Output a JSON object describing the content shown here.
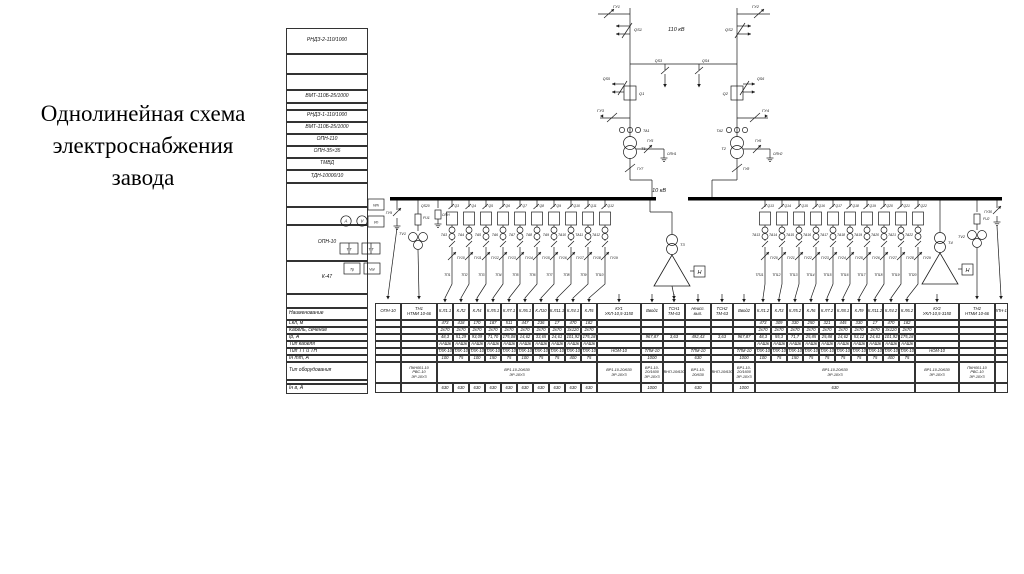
{
  "title": {
    "line1": "Однолинейная схема",
    "line2": "электроснабжения",
    "line3": "завода"
  },
  "legend": {
    "items": [
      "РНДЗ-2-110/1000",
      "",
      "",
      "ВМТ-110Б-25/1000",
      "",
      "РНДЗ-1-110/1000",
      "ВМТ-110Б-25/1000",
      "ОПН-110",
      "ОПН-35×35",
      "ТМВД",
      "ТДН-10000/10",
      "",
      "",
      "ОПН-10",
      "К-47",
      ""
    ]
  },
  "row_headers": [
    "Наименование",
    "Lкл, м",
    "Кабель, сечение",
    "Iр, А",
    "Тип кабеля",
    "Тип ТТ и ТН",
    "Iн тт, А",
    "Тип оборудования",
    "",
    "Iн в, А"
  ],
  "diagram": {
    "voltage_high": "110 кВ",
    "voltage_low": "10 кВ",
    "left_incomer": {
      "gu_top": "ГУ1",
      "qs": "QS1",
      "qs_low": "QS5",
      "q": "Q1",
      "gu_line": "ГУ3",
      "ta": "ТА1",
      "tr": "Т1",
      "gu_opn": "ГУ5",
      "opn": "ОПН1",
      "gu_sw": "ГУ7"
    },
    "right_incomer": {
      "gu_top": "ГУ2",
      "qs": "QS2",
      "qs_low": "QS6",
      "q": "Q2",
      "gu_line": "ГУ4",
      "ta": "ТА2",
      "tr": "Т2",
      "gu_opn": "ГУ6",
      "opn": "ОПН2",
      "gu_sw": "ГУ8"
    },
    "tie": {
      "qs_left": "QS3",
      "qs_right": "QS4"
    },
    "vt_left": {
      "label": "ТV1",
      "fuse": "FU1",
      "qs": "QS20",
      "gu": "ГУ9",
      "opn": "ОПН"
    },
    "vt_right": {
      "label": "ТV2",
      "fuse": "FU2",
      "gu": "ГУ30"
    },
    "tsn_left": {
      "tr": "Т3",
      "load": "Н"
    },
    "tsn_right": {
      "tr": "Т4",
      "load": "Н"
    },
    "instruments": [
      {
        "shape": "box",
        "label": "Wh"
      },
      {
        "shape": "circle",
        "label": "A"
      },
      {
        "shape": "circle",
        "label": "V"
      },
      {
        "shape": "box",
        "label": "Vh"
      },
      {
        "shape": "box2",
        "label": "Т Т"
      },
      {
        "shape": "box2",
        "label": "Т Т"
      },
      {
        "shape": "box",
        "label": "Тр"
      },
      {
        "shape": "box",
        "label": "Var"
      }
    ],
    "left_feeders": [
      {
        "q": "Q3",
        "ta": "ТА3",
        "gu": "ГУ10",
        "tp": "ТП1"
      },
      {
        "q": "Q4",
        "ta": "ТА4",
        "gu": "ГУ11",
        "tp": "ТП2"
      },
      {
        "q": "Q5",
        "ta": "ТА5",
        "gu": "ГУ12",
        "tp": "ТП3"
      },
      {
        "q": "Q6",
        "ta": "ТА6",
        "gu": "ГУ13",
        "tp": "ТП4"
      },
      {
        "q": "Q7",
        "ta": "ТА7",
        "gu": "ГУ14",
        "tp": "ТП5"
      },
      {
        "q": "Q8",
        "ta": "ТА8",
        "gu": "ГУ15",
        "tp": "ТП6"
      },
      {
        "q": "Q9",
        "ta": "ТА9",
        "gu": "ГУ16",
        "tp": "ТП7"
      },
      {
        "q": "Q10",
        "ta": "ТА10",
        "gu": "ГУ17",
        "tp": "ТП8"
      },
      {
        "q": "Q11",
        "ta": "ТА11",
        "gu": "ГУ18",
        "tp": "ТП9"
      },
      {
        "q": "Q12",
        "ta": "ТА12",
        "gu": "ГУ19",
        "tp": "ТП10"
      }
    ],
    "right_feeders": [
      {
        "q": "Q13",
        "ta": "ТА13",
        "gu": "ГУ20",
        "tp": "ТП11"
      },
      {
        "q": "Q14",
        "ta": "ТА14",
        "gu": "ГУ21",
        "tp": "ТП12"
      },
      {
        "q": "Q15",
        "ta": "ТА15",
        "gu": "ГУ22",
        "tp": "ТП13"
      },
      {
        "q": "Q16",
        "ta": "ТА16",
        "gu": "ГУ23",
        "tp": "ТП14"
      },
      {
        "q": "Q17",
        "ta": "ТА17",
        "gu": "ГУ24",
        "tp": "ТП15"
      },
      {
        "q": "Q18",
        "ta": "ТА18",
        "gu": "ГУ25",
        "tp": "ТП16"
      },
      {
        "q": "Q19",
        "ta": "ТА19",
        "gu": "ГУ26",
        "tp": "ТП17"
      },
      {
        "q": "Q20",
        "ta": "ТА20",
        "gu": "ГУ27",
        "tp": "ТП18"
      },
      {
        "q": "Q21",
        "ta": "ТА21",
        "gu": "ГУ28",
        "tp": "ТП19"
      },
      {
        "q": "Q22",
        "ta": "ТА22",
        "gu": "ГУ29",
        "tp": "ТП20"
      }
    ]
  },
  "table": {
    "merged": {
      "equip_left": "ВР1-10-20/630\nЭР-10У3",
      "equip_right": "ВР1-10-20/630\nЭР-10У3",
      "inb_right": "630"
    },
    "columns": [
      {
        "n": "ОПН-10"
      },
      {
        "n": "ТН1",
        "n2": "НТМИ 10-66",
        "eq": "ПКН001-10\nРВС-10\nЭР-10У3"
      },
      {
        "n": "К.Л1.1",
        "l": "473",
        "s": "2х70",
        "ir": "48,3",
        "c": "ААШв",
        "tt": "ТЛК-10",
        "it": "100",
        "ib": "630"
      },
      {
        "n": "К.Л2",
        "l": "418",
        "s": "2х70",
        "ir": "51,29",
        "c": "ААШв",
        "tt": "ТЛК-10",
        "it": "75",
        "ib": "630"
      },
      {
        "n": "К.Л4",
        "l": "170",
        "s": "2х70",
        "ir": "93,09",
        "c": "ААШв",
        "tt": "ТЛК-10",
        "it": "100",
        "ib": "630"
      },
      {
        "n": "К.Л5.1",
        "l": "187",
        "s": "2х70",
        "ir": "71,70",
        "c": "ААШв",
        "tt": "ТЛК-10",
        "it": "150",
        "ib": "630"
      },
      {
        "n": "К.Л7.1",
        "l": "511",
        "s": "2х70",
        "ir": "175,08",
        "c": "ААШв",
        "tt": "ТЛК-10",
        "it": "75",
        "ib": "630"
      },
      {
        "n": "К.Л6.1",
        "l": "447",
        "s": "2х70",
        "ir": "14,62",
        "c": "ААШв",
        "tt": "ТЛК-10",
        "it": "100",
        "ib": "630"
      },
      {
        "n": "К.Л10",
        "l": "236",
        "s": "2х70",
        "ir": "33,65",
        "c": "ААШв",
        "tt": "ТЛК-10",
        "it": "75",
        "ib": "630"
      },
      {
        "n": "К.Л11.1",
        "l": "17",
        "s": "2х70",
        "ir": "24,61",
        "c": "ААШв",
        "tt": "ТЛК-10",
        "it": "75",
        "ib": "630"
      },
      {
        "n": "К.Л4.1",
        "l": "470",
        "s": "3х120",
        "ir": "101,92",
        "c": "ААШв",
        "tt": "ТЛК-10",
        "it": "400",
        "ib": "630"
      },
      {
        "n": "К.Л5",
        "l": "182",
        "s": "2х70",
        "ir": "175,18",
        "c": "ААШв",
        "tt": "ТЛК-10",
        "it": "75",
        "ib": "630"
      },
      {
        "n": "КУ1",
        "n2": "УКЛ-10,5-3150",
        "tt": "НОМ-10",
        "eq": "ВР1-10-20/630\nЭР-10У3"
      },
      {
        "n": "Ввод1",
        "ir": "967,87",
        "tt": "ТЛМ-10",
        "it": "1000",
        "eq": "ВР1-10-20/1600\nЭР-10У3",
        "ib": "1000"
      },
      {
        "n": "ТСН1",
        "n2": "ТМ-63",
        "ir": "3,63",
        "eq": "ВНП-10/630"
      },
      {
        "n": "Неисп.",
        "n2": "вып.",
        "ir": "492,43",
        "tt": "ТЛМ-10",
        "it": "630",
        "eq": "ВР1-10-20/630",
        "ib": "630"
      },
      {
        "n": "ТСН2",
        "n2": "ТМ-63",
        "ir": "3,63",
        "eq": "ВНП-10/630"
      },
      {
        "n": "Ввод2",
        "ir": "967,87",
        "tt": "ТЛМ-10",
        "it": "1000",
        "eq": "ВР1-10-20/1600\nЭР-10У3",
        "ib": "1000"
      },
      {
        "n": "К.Л1.2",
        "l": "473",
        "s": "2х70",
        "ir": "48,3",
        "c": "ААШв",
        "tt": "ТЛК-10",
        "it": "100"
      },
      {
        "n": "К.Л3",
        "l": "309",
        "s": "2х70",
        "ir": "55,3",
        "c": "ААШв",
        "tt": "ТЛК-10",
        "it": "75"
      },
      {
        "n": "К.Л5.2",
        "l": "330",
        "s": "2х70",
        "ir": "71,7",
        "c": "ААШв",
        "tt": "ТЛК-10",
        "it": "150"
      },
      {
        "n": "К.Л6",
        "l": "250",
        "s": "2х70",
        "ir": "25,85",
        "c": "ААШв",
        "tt": "ТЛК-10",
        "it": "75"
      },
      {
        "n": "К.Л7.2",
        "l": "321",
        "s": "2х70",
        "ir": "25,88",
        "c": "ААШв",
        "tt": "ТЛК-10",
        "it": "75"
      },
      {
        "n": "К.Л8.1",
        "l": "445",
        "s": "2х70",
        "ir": "14,62",
        "c": "ААШв",
        "tt": "ТЛК-10",
        "it": "75"
      },
      {
        "n": "К.Л9",
        "l": "330",
        "s": "2х70",
        "ir": "53,12",
        "c": "ААШв",
        "tt": "ТЛК-10",
        "it": "75"
      },
      {
        "n": "К.Л11.2",
        "l": "17",
        "s": "2х70",
        "ir": "24,61",
        "c": "ААШв",
        "tt": "ТЛК-10",
        "it": "75"
      },
      {
        "n": "К.Л4.2",
        "l": "470",
        "s": "3х120",
        "ir": "101,92",
        "c": "ААШв",
        "tt": "ТЛК-10",
        "it": "400"
      },
      {
        "n": "К.Л6.2",
        "l": "182",
        "s": "2х70",
        "ir": "175,18",
        "c": "ААШв",
        "tt": "ТЛК-10",
        "it": "75"
      },
      {
        "n": "КУ2",
        "n2": "УКЛ-10,5-3150",
        "tt": "НОМ-10",
        "eq": "ВР1-10-20/630\nЭР-10У3"
      },
      {
        "n": "ТН2",
        "n2": "НТМИ 10-66",
        "eq": "ПКН001-10\nРВС-10\nЭР-10У3"
      },
      {
        "n": "ОПН-10"
      }
    ]
  }
}
